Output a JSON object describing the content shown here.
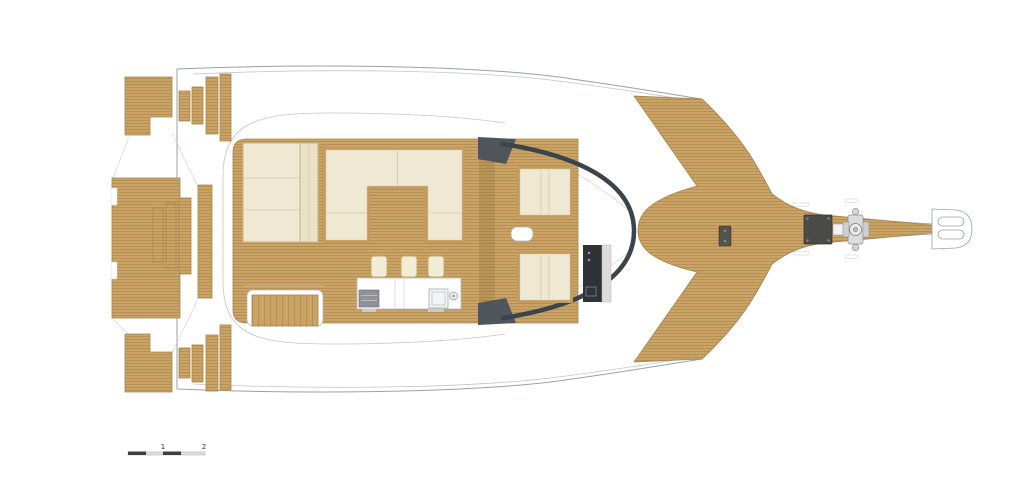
{
  "figure": {
    "scale_bar": {
      "label_1": "1",
      "label_2": "2"
    },
    "colors": {
      "background": "#FFFFFF",
      "hull_outline": "#9AA0A5",
      "teak": "#CBA465",
      "teak_stripe": "#B28C50",
      "teak_edge": "#A6874E",
      "upholstery": "#EFE9D3",
      "upholstery_trim": "#C49A5E",
      "windshield": "#3A444C",
      "superstructure_dark": "#4E565C",
      "console_dark": "#2E3338",
      "console_panel": "#DCDCDC",
      "hatch_dark": "#4A4A48",
      "scale_bar_dark": "#3F3F3F"
    }
  }
}
